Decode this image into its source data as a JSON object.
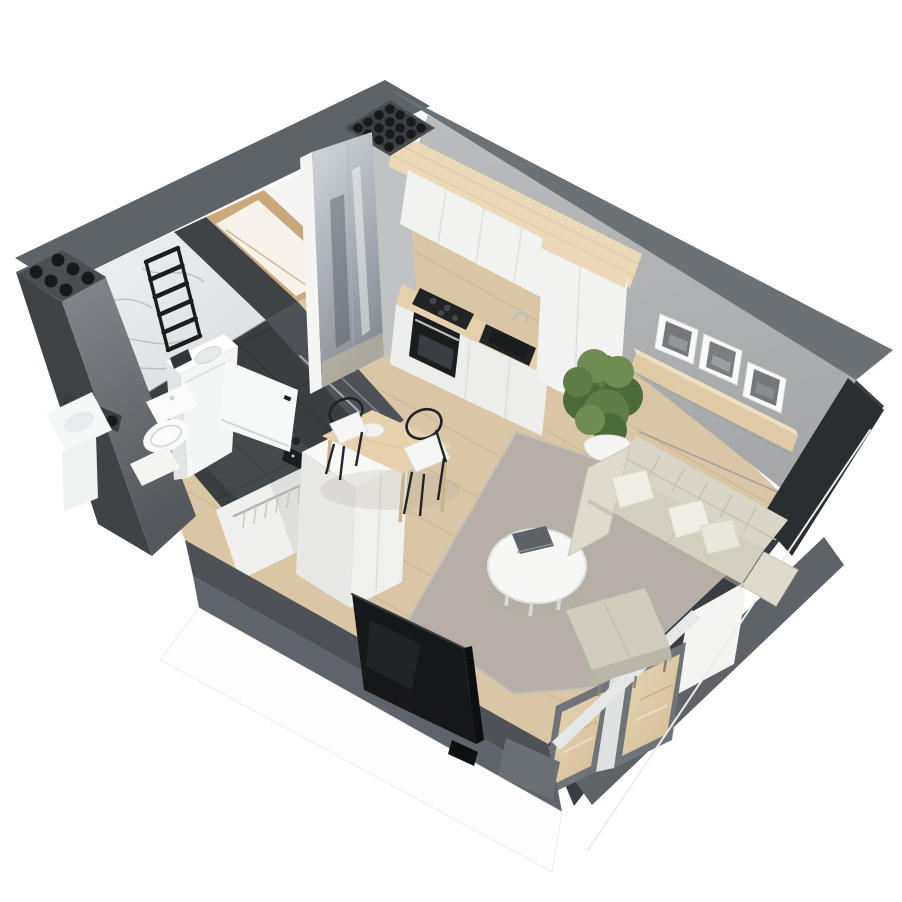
{
  "meta": {
    "title": "Isometric 3D floor plan render of a studio apartment",
    "canvas": {
      "width": 902,
      "height": 902
    }
  },
  "palette": {
    "bg": "#ffffff",
    "wallTop": "#5e6367",
    "wallTopLight": "#6c7175",
    "wallDark": "#3f4346",
    "blackWall": "#2b2e31",
    "seFace": "#3a3d41",
    "swFace": "#4e5256",
    "swBand": "#5f646a",
    "swStep": "#6b7074",
    "grayWallA": "#bcbdbf",
    "grayWallB": "#a6a8aa",
    "grayPillar": "#c0c2c4",
    "colFaceA": "#84878b",
    "colFaceB": "#55585c",
    "ledge": "#3a3d40",
    "marbleA": "#f0f1f3",
    "marbleB": "#d9dbde",
    "vein": "#b6bac1",
    "jamb": "#3f4346",
    "doorWood": "#caa87c",
    "doorWoodDark": "#b99568",
    "doorGlow": "#f8f3ea",
    "doorLeaf": "#f7f8f8",
    "whiteWall": "#f5f5f4",
    "mirrorA": "#d4d9dd",
    "mirrorB": "#878e95",
    "mirrorDark": "#3c4347",
    "floorWood": "#d8c6a4",
    "plankLine": "#c2ab83",
    "bathFloor": "#3a3e41",
    "bathTile": "#2c3034",
    "ventPlate": "#4a4e52",
    "ventPlateInner": "#3a3e42",
    "ventHole": "#17191b",
    "beamWood": "#ead8b6",
    "beamLine": "#d9c49c",
    "cabinet": "#f2f2f1",
    "cabinetSeam": "#dfdfdd",
    "counterWood": "#e4d1ac",
    "baseCab": "#ededeb",
    "applianceDark": "#212325",
    "applianceDarker": "#1a1c1e",
    "steel": "#b9bec2",
    "shelfWood": "#decba6",
    "shelfTop": "#ecdfc2",
    "frameWhite": "#fafafa",
    "photoA": "#75777b",
    "photoB": "#7b7d80",
    "pierWhite": "#f4f4f3",
    "sill": "#e6e7e7",
    "winFrame": "#6f7478",
    "glassWoodA": "#d2bc94",
    "glassWoodB": "#e6d6b4",
    "rug": "#b5afa7",
    "rugEdge": "#c5c0b8",
    "sofa": "#d2cec0",
    "sofaBack": "#dad6c7",
    "sofaArm": "#dfdbcc",
    "sofaSeam": "#c6c2b2",
    "pillow": "#f0ede5",
    "pillowEdge": "#ddd9cc",
    "ottoman": "#d0ccbd",
    "ottomanSide": "#bbb7a8",
    "tableWood": "#e6d3ad",
    "tableLeg": "#c9b48e",
    "chairBlack": "#222426",
    "chairSeat": "#f6f6f4",
    "coffeeTable": "#f7f7f5",
    "coffeeRim": "#e2e2df",
    "book": "#5d6266",
    "tv": "#17181a",
    "tvEdge": "#0e0f10",
    "tvGlare": "#2a2c2f",
    "plantA": "#5f7d45",
    "plantB": "#4d6a39",
    "plantC": "#6f8d52",
    "stem": "#8a7a58",
    "pot": "#f4f4f2",
    "potShade": "#d9d9d6",
    "soil": "#3b2f25",
    "wmBody": "#f4f5f5",
    "wmPanel": "#33363a",
    "toilet": "#fbfbfb",
    "basin": "#f6f7f7",
    "matWhite": "#f4f4f3",
    "wardrobeTop": "#f8f8f7",
    "wardrobeFace": "#f0f0ee",
    "wardrobeSide": "#e7e7e5",
    "wardrobeInner": "#efefed",
    "wardrobeShade": "#dededc",
    "hangerRail": "#b5b5b3",
    "hanger": "#c8c8c6",
    "glassLine": "#ffffff",
    "shadowSoft": "#b3afa2",
    "outerEdge": "#ececec",
    "baseShadow": "#96989a"
  },
  "scene": {
    "style": "isometric cutaway apartment render, anthracite wall tops, white exterior",
    "rooms": [
      {
        "id": "bathroom",
        "features": [
          "marble accent wall",
          "black towel ladder radiator",
          "top-load washing machine",
          "wall-hung toilet",
          "washbasin",
          "walk-in shower",
          "dark tile floor",
          "bath mat",
          "open white door"
        ]
      },
      {
        "id": "entry-hall",
        "features": [
          "wood framed doorway",
          "mirrored wardrobe panel"
        ]
      },
      {
        "id": "living-kitchen",
        "features": [
          "white kitchen cabinets",
          "wood worktop",
          "black cooktop",
          "black oven",
          "black sink with faucet",
          "tall cabinet column",
          "wood ceiling beam",
          "dining table",
          "two black wire chairs",
          "white wardrobe with hanging rail",
          "gray area rug",
          "round white coffee table",
          "beige fabric sofa with white pillows",
          "ottoman",
          "potted floor plant",
          "wood wall shelf with three framed pictures",
          "flat screen tv",
          "glazed balcony doors"
        ]
      }
    ],
    "building": [
      "north ventilation grille",
      "west ventilation grille",
      "oak plank flooring",
      "gray feature walls"
    ]
  }
}
